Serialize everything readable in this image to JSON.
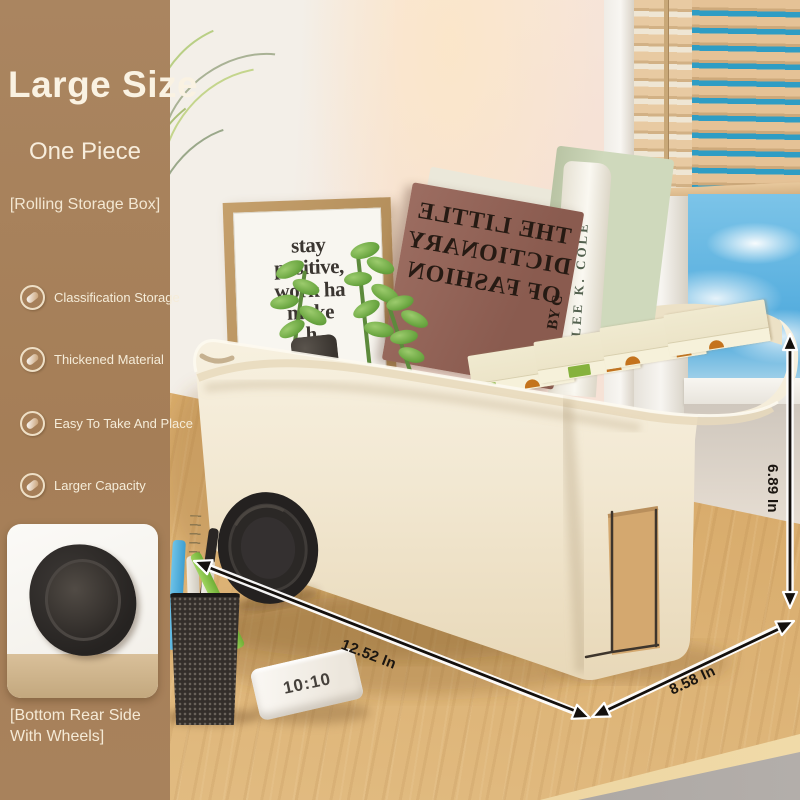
{
  "sidebar": {
    "title": "Large Size",
    "subtitle": "One Piece",
    "tagline": "[Rolling Storage Box]",
    "features": [
      {
        "label": "Classification Storage"
      },
      {
        "label": "Thickened Material"
      },
      {
        "label": "Easy To Take And Place"
      },
      {
        "label": "Larger Capacity"
      }
    ],
    "inset_caption": "[Bottom Rear Side With Wheels]"
  },
  "annotations": {
    "width_label": "12.52 In",
    "depth_label": "8.58 In",
    "height_label": "6.89 In"
  },
  "scene": {
    "clock_text": "10:10",
    "frame_quote": {
      "lines": [
        "stay",
        "positive,",
        "work ha",
        "make",
        "h"
      ]
    },
    "brown_book": {
      "lines": [
        "THE LITTLE",
        "DICTIONARY",
        "OF FASHION"
      ],
      "spine": "BY C"
    },
    "white_book_spine": "LEE K. COLE"
  },
  "colors": {
    "sidebar_brown": "#a7815b",
    "box_cream": "#f3ebd7",
    "desk_wood": "#d9ae74",
    "sky_blue": "#2f9dc4",
    "arrow_black": "#141008"
  }
}
